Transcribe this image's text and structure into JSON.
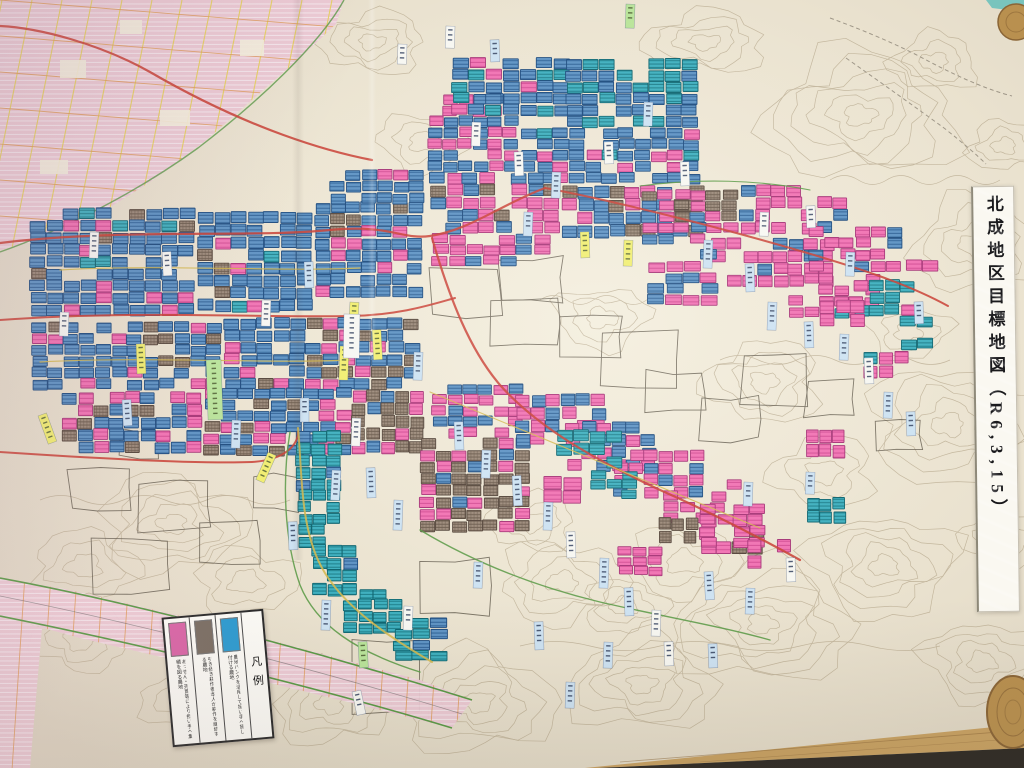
{
  "poster": {
    "title": "北成地区目標地図（R6,3,15）",
    "legend": {
      "heading": "凡例",
      "items": [
        {
          "name": "pink",
          "hex": "#d966a6",
          "label": "あっせん・売買等により担い手へ集積を図る農地"
        },
        {
          "name": "gray",
          "hex": "#7b6f64",
          "label": "引き続き耕作者本人が耕作を継続する農地"
        },
        {
          "name": "blue",
          "hex": "#2d9bd0",
          "label": "農地バンクを活用して担い手へ貸し付ける農地"
        }
      ]
    }
  },
  "colors": {
    "paper": "#eae2cf",
    "paper_light": "#f4eedd",
    "paper_dark": "#ded5c2",
    "contour": "#b9ab90",
    "outline": "#5f584a",
    "trail": "#8a8274",
    "parcel_blue": "#5e93c4",
    "parcel_blue_line": "#2d5f94",
    "parcel_blue_stroke": "#1d4b7e",
    "parcel_teal": "#3fb0bf",
    "parcel_teal_line": "#1b7a86",
    "parcel_teal_stroke": "#0f6570",
    "parcel_pink": "#f173b3",
    "parcel_pink_line": "#d14b92",
    "parcel_pink_stroke": "#a63577",
    "parcel_brown": "#9c8a7a",
    "parcel_brown_line": "#6a594b",
    "parcel_brown_stroke": "#54453a",
    "adjacent_pink": "#ecc9d4",
    "adjacent_stripe": "#f7e9ef",
    "grid_yellow": "#e5d052",
    "grid_orange": "#df9a55",
    "road_red": "#c94136",
    "road_yellow": "#d4b84e",
    "boundary_green": "#5a9a46",
    "label_white": "#f7f7f2",
    "label_blue": "#cde2f2",
    "label_green": "#b9e49a",
    "label_yellow": "#f1ee70",
    "label_pink": "#f7bccb",
    "wood": "#c9a263",
    "wood_dark": "#8a6536",
    "knob_wood": "#b9904f",
    "shadow": "#2e2a24",
    "teal_object": "#79c4bd"
  }
}
